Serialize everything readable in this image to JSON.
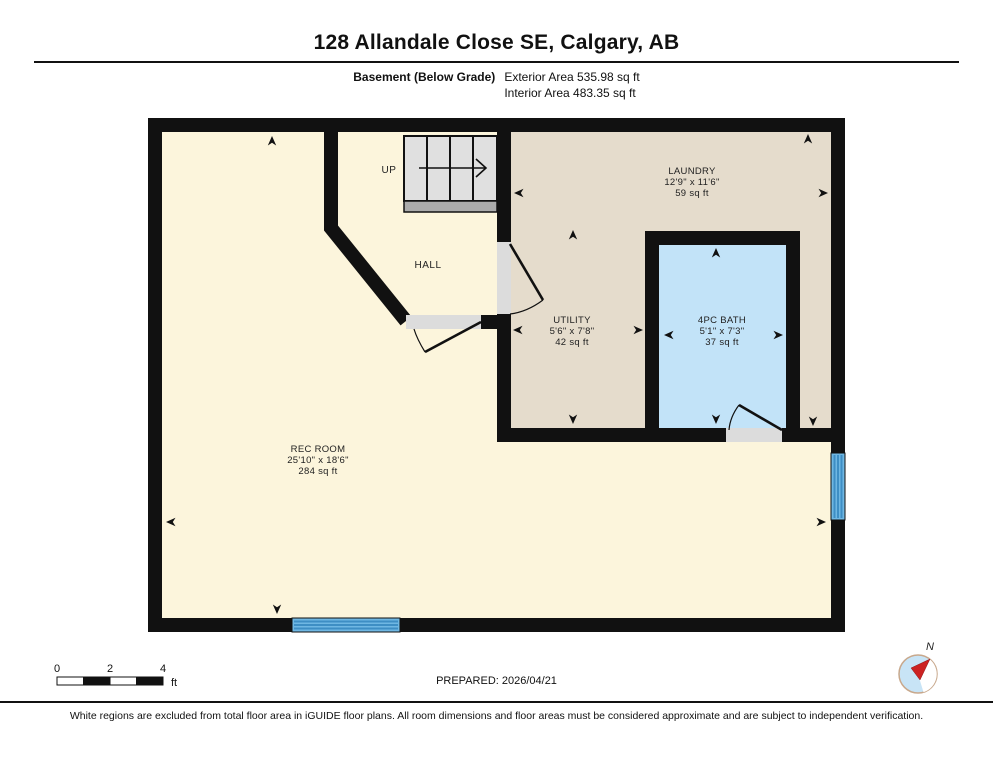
{
  "header": {
    "title": "128 Allandale Close SE, Calgary, AB",
    "floor_label": "Basement (Below Grade)",
    "exterior_area": "Exterior Area 535.98 sq ft",
    "interior_area": "Interior Area 483.35 sq ft"
  },
  "plan": {
    "stairs_label": "UP",
    "hall_label": "HALL",
    "rooms": {
      "laundry": {
        "name": "LAUNDRY",
        "dims": "12'9\" x 11'6\"",
        "area": "59 sq ft"
      },
      "utility": {
        "name": "UTILITY",
        "dims": "5'6\" x 7'8\"",
        "area": "42 sq ft"
      },
      "bath": {
        "name": "4PC BATH",
        "dims": "5'1\" x 7'3\"",
        "area": "37 sq ft"
      },
      "rec_room": {
        "name": "REC ROOM",
        "dims": "25'10\" x 18'6\"",
        "area": "284 sq ft"
      }
    },
    "colors": {
      "rec_room_fill": "#FCF5DC",
      "laundry_fill": "#E5DCCC",
      "bath_fill": "#C2E3F8",
      "window_fill": "#6FB7E3",
      "wall": "#111111"
    }
  },
  "footer": {
    "scale": {
      "tick0": "0",
      "tick2": "2",
      "tick4": "4",
      "unit": "ft"
    },
    "prepared": "PREPARED: 2026/04/21",
    "compass_label": "N",
    "disclaimer": "White regions are excluded from total floor area in iGUIDE floor plans. All room dimensions and floor areas must be considered approximate and are subject to independent verification."
  }
}
